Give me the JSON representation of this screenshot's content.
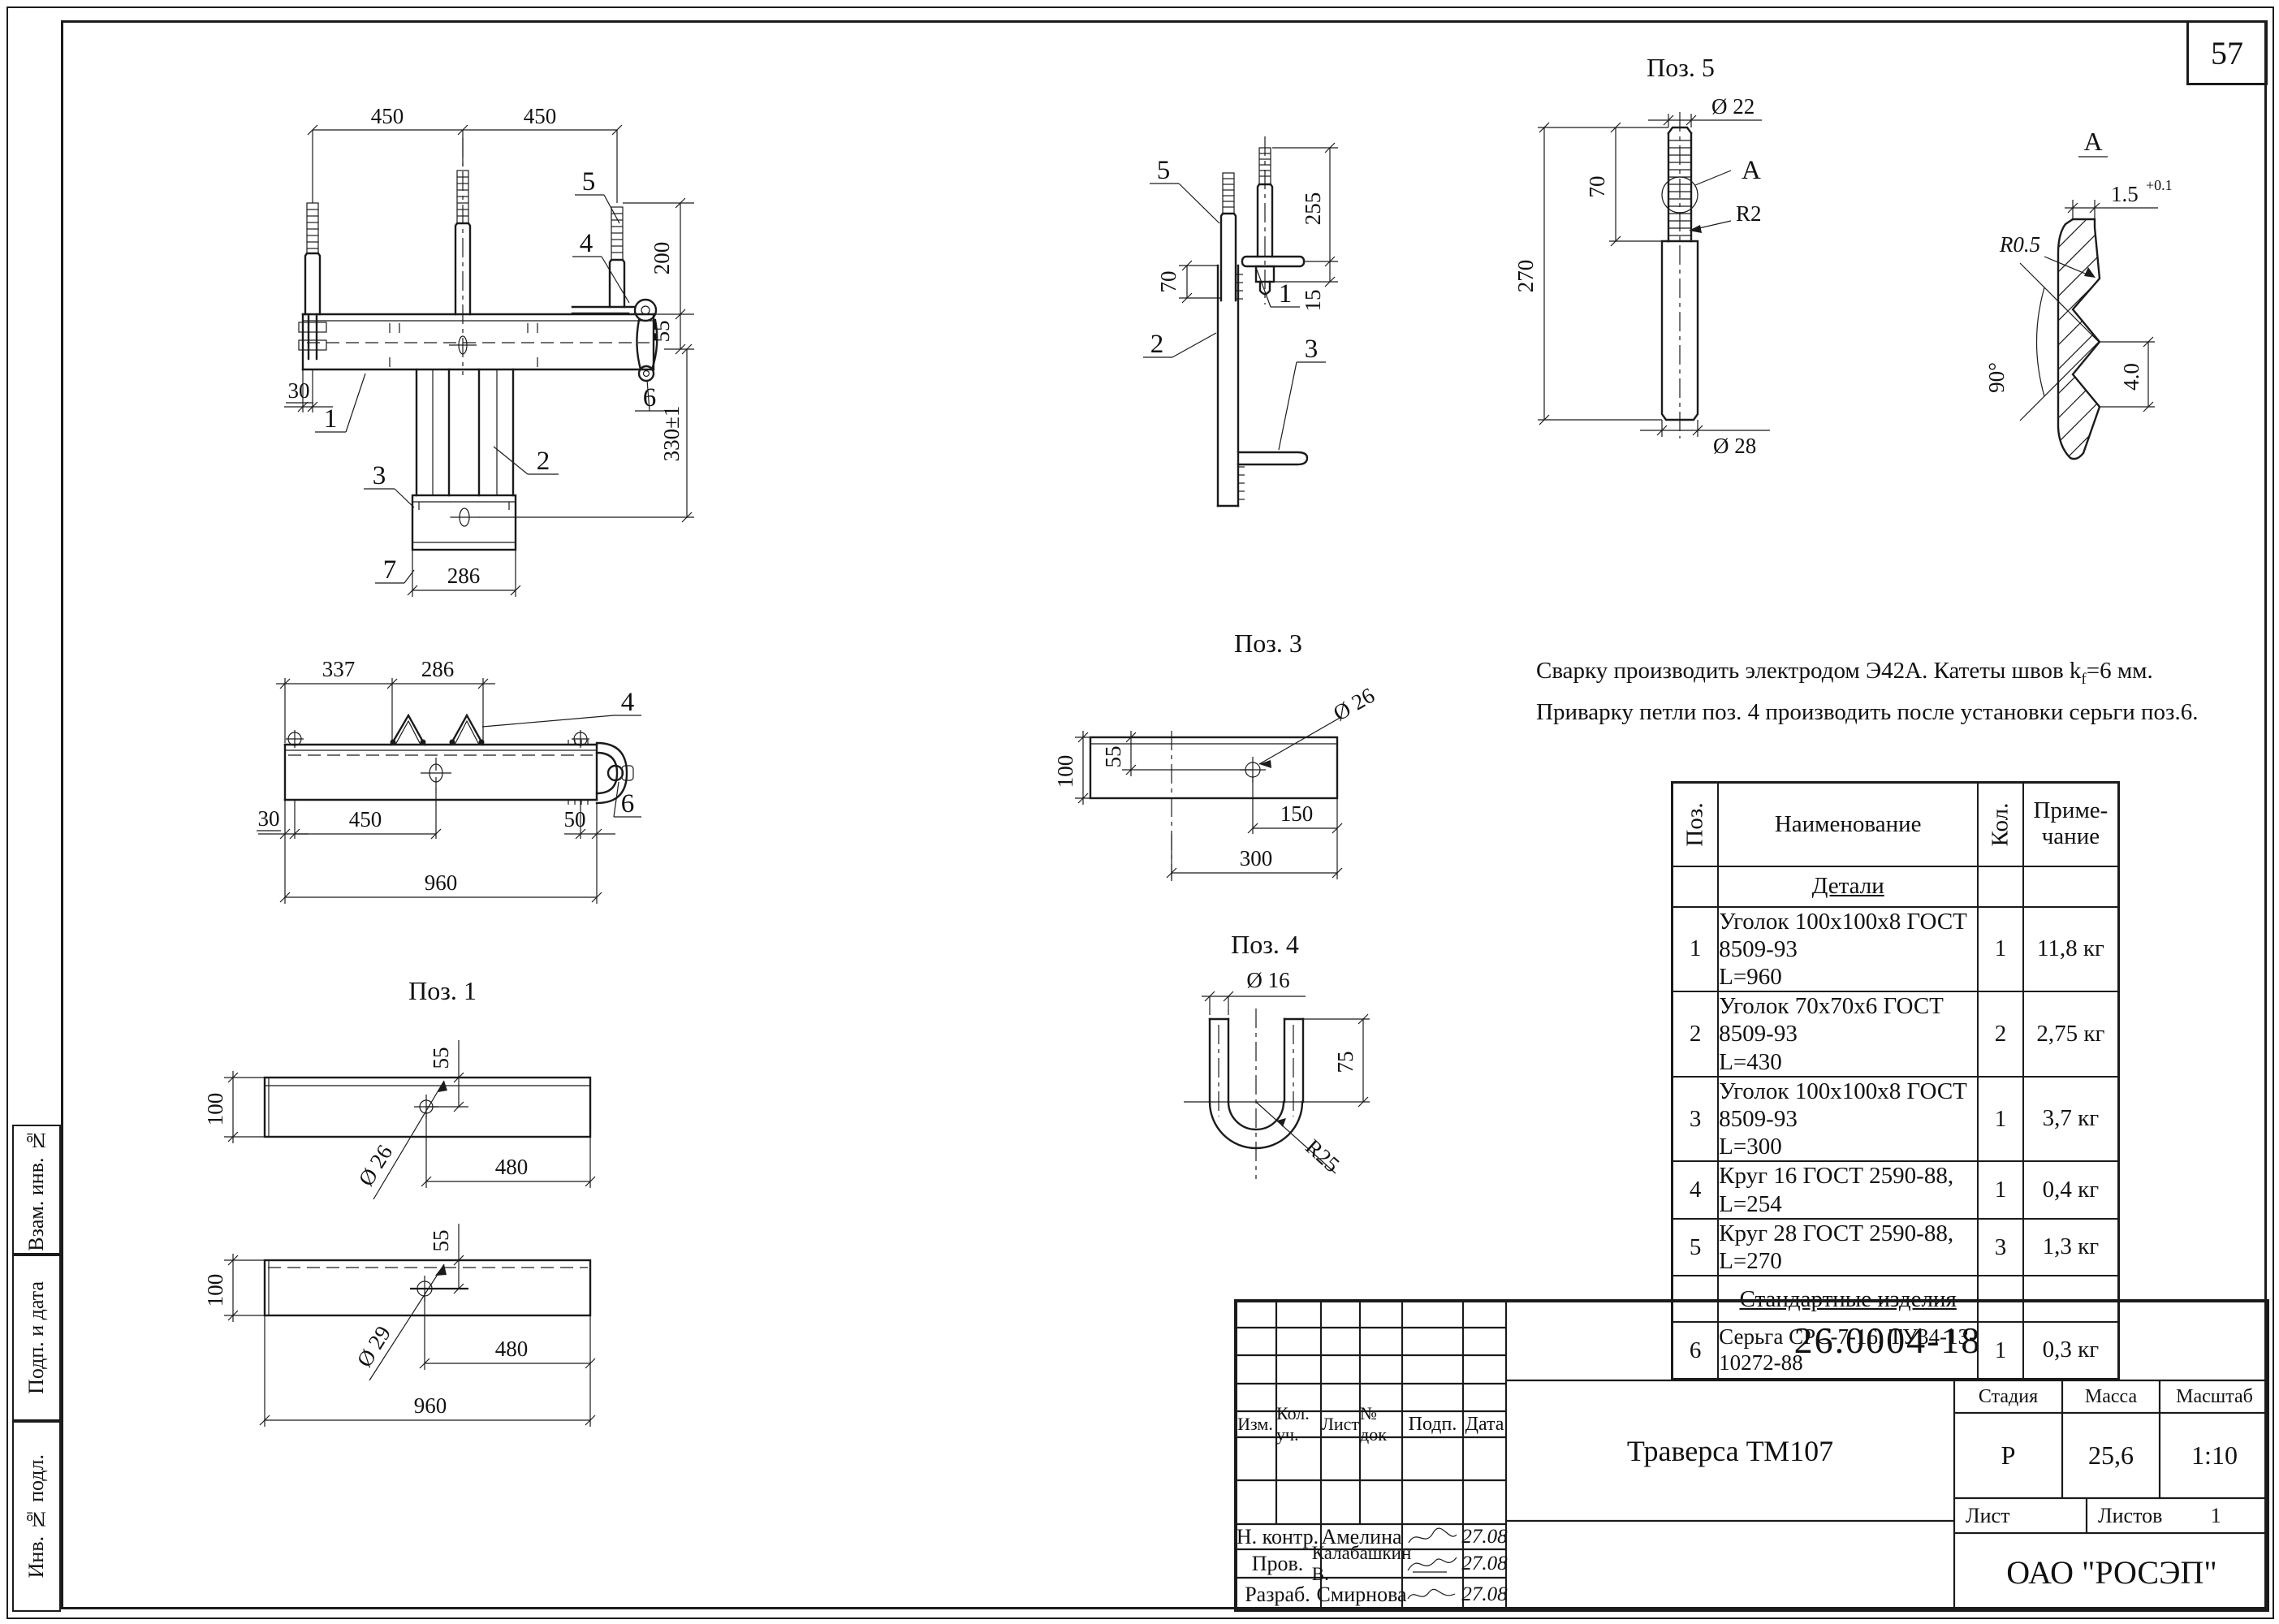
{
  "page_number": "57",
  "notes": {
    "line1_pre": "Сварку производить электродом Э42А. Катеты швов k",
    "line1_sub": "f",
    "line1_post": "=6 мм.",
    "line2": "Приварку петли поз. 4 производить после установки серьги поз.6."
  },
  "views": {
    "front": {
      "d450a": "450",
      "d450b": "450",
      "d200": "200",
      "d55": "55",
      "d330": "330±1",
      "d30": "30",
      "d286": "286",
      "l1": "1",
      "l2": "2",
      "l3": "3",
      "l4": "4",
      "l5": "5",
      "l6": "6",
      "l7": "7"
    },
    "side": {
      "d255": "255",
      "d70": "70",
      "d15": "15",
      "l1": "1",
      "l2": "2",
      "l3": "3",
      "l5": "5"
    },
    "pos5": {
      "title": "Поз. 5",
      "dia22": "Ø 22",
      "d70": "70",
      "d270": "270",
      "dia28": "Ø 28",
      "r2": "R2",
      "a": "А"
    },
    "detailA": {
      "title": "А",
      "d15": "1.5",
      "tol": "+0.1",
      "r05": "R0.5",
      "ang": "90°",
      "d40": "4.0"
    },
    "plan": {
      "d337": "337",
      "d286": "286",
      "d30": "30",
      "d450": "450",
      "d50": "50",
      "d960": "960",
      "l4": "4",
      "l6": "6"
    },
    "pos3": {
      "title": "Поз. 3",
      "d100": "100",
      "d55": "55",
      "dia26": "Ø 26",
      "d150": "150",
      "d300": "300"
    },
    "pos4": {
      "title": "Поз. 4",
      "dia16": "Ø 16",
      "d75": "75",
      "r25": "R25"
    },
    "pos1": {
      "title": "Поз. 1",
      "b1_100": "100",
      "b1_55": "55",
      "b1_dia": "Ø 26",
      "b1_480": "480",
      "b2_100": "100",
      "b2_55": "55",
      "b2_dia": "Ø 29",
      "b2_480": "480",
      "b2_960": "960"
    }
  },
  "table": {
    "h_pos": "Поз.",
    "h_name": "Наименование",
    "h_qty": "Кол.",
    "h_note": "Приме-\nчание",
    "sec1": "Детали",
    "rows": [
      {
        "pos": "1",
        "name": "Уголок 100х100х8 ГОСТ 8509-93\nL=960",
        "qty": "1",
        "note": "11,8 кг"
      },
      {
        "pos": "2",
        "name": "Уголок 70х70х6 ГОСТ 8509-93\nL=430",
        "qty": "2",
        "note": "2,75 кг"
      },
      {
        "pos": "3",
        "name": "Уголок 100х100х8 ГОСТ 8509-93\nL=300",
        "qty": "1",
        "note": "3,7 кг"
      },
      {
        "pos": "4",
        "name": "Круг 16 ГОСТ 2590-88, L=254",
        "qty": "1",
        "note": "0,4 кг"
      },
      {
        "pos": "5",
        "name": "Круг 28 ГОСТ 2590-88, L=270",
        "qty": "3",
        "note": "1,3 кг"
      }
    ],
    "sec2": "Стандартные изделия",
    "row6": {
      "pos": "6",
      "name": "Серьга СРС-7-16,  ТУ34-13-10272-88",
      "qty": "1",
      "note": "0,3 кг"
    }
  },
  "title_block": {
    "doc_number": "26.0004-18",
    "product_name": "Траверса ТМ107",
    "stage_label": "Стадия",
    "mass_label": "Масса",
    "scale_label": "Масштаб",
    "stage": "Р",
    "mass": "25,6",
    "scale": "1:10",
    "sheet_label": "Лист",
    "sheets_label": "Листов",
    "sheets_value": "1",
    "company": "ОАО \"РОСЭП\"",
    "col_izm": "Изм.",
    "col_kol": "Кол. уч.",
    "col_list": "Лист",
    "col_ndok": "№ док",
    "col_podp": "Подп.",
    "col_data": "Дата",
    "sig1_role": "Н. контр.",
    "sig1_name": "Амелина",
    "sig1_date": "27.08",
    "sig2_role": "Пров.",
    "sig2_name": "Калабашкин В.",
    "sig2_date": "27.08",
    "sig3_role": "Разраб.",
    "sig3_name": "Смирнова",
    "sig3_date": "27.08"
  },
  "margin": {
    "c1": "Взам. инв. №",
    "c2": "Подп. и дата",
    "c3": "Инв. № подл."
  }
}
